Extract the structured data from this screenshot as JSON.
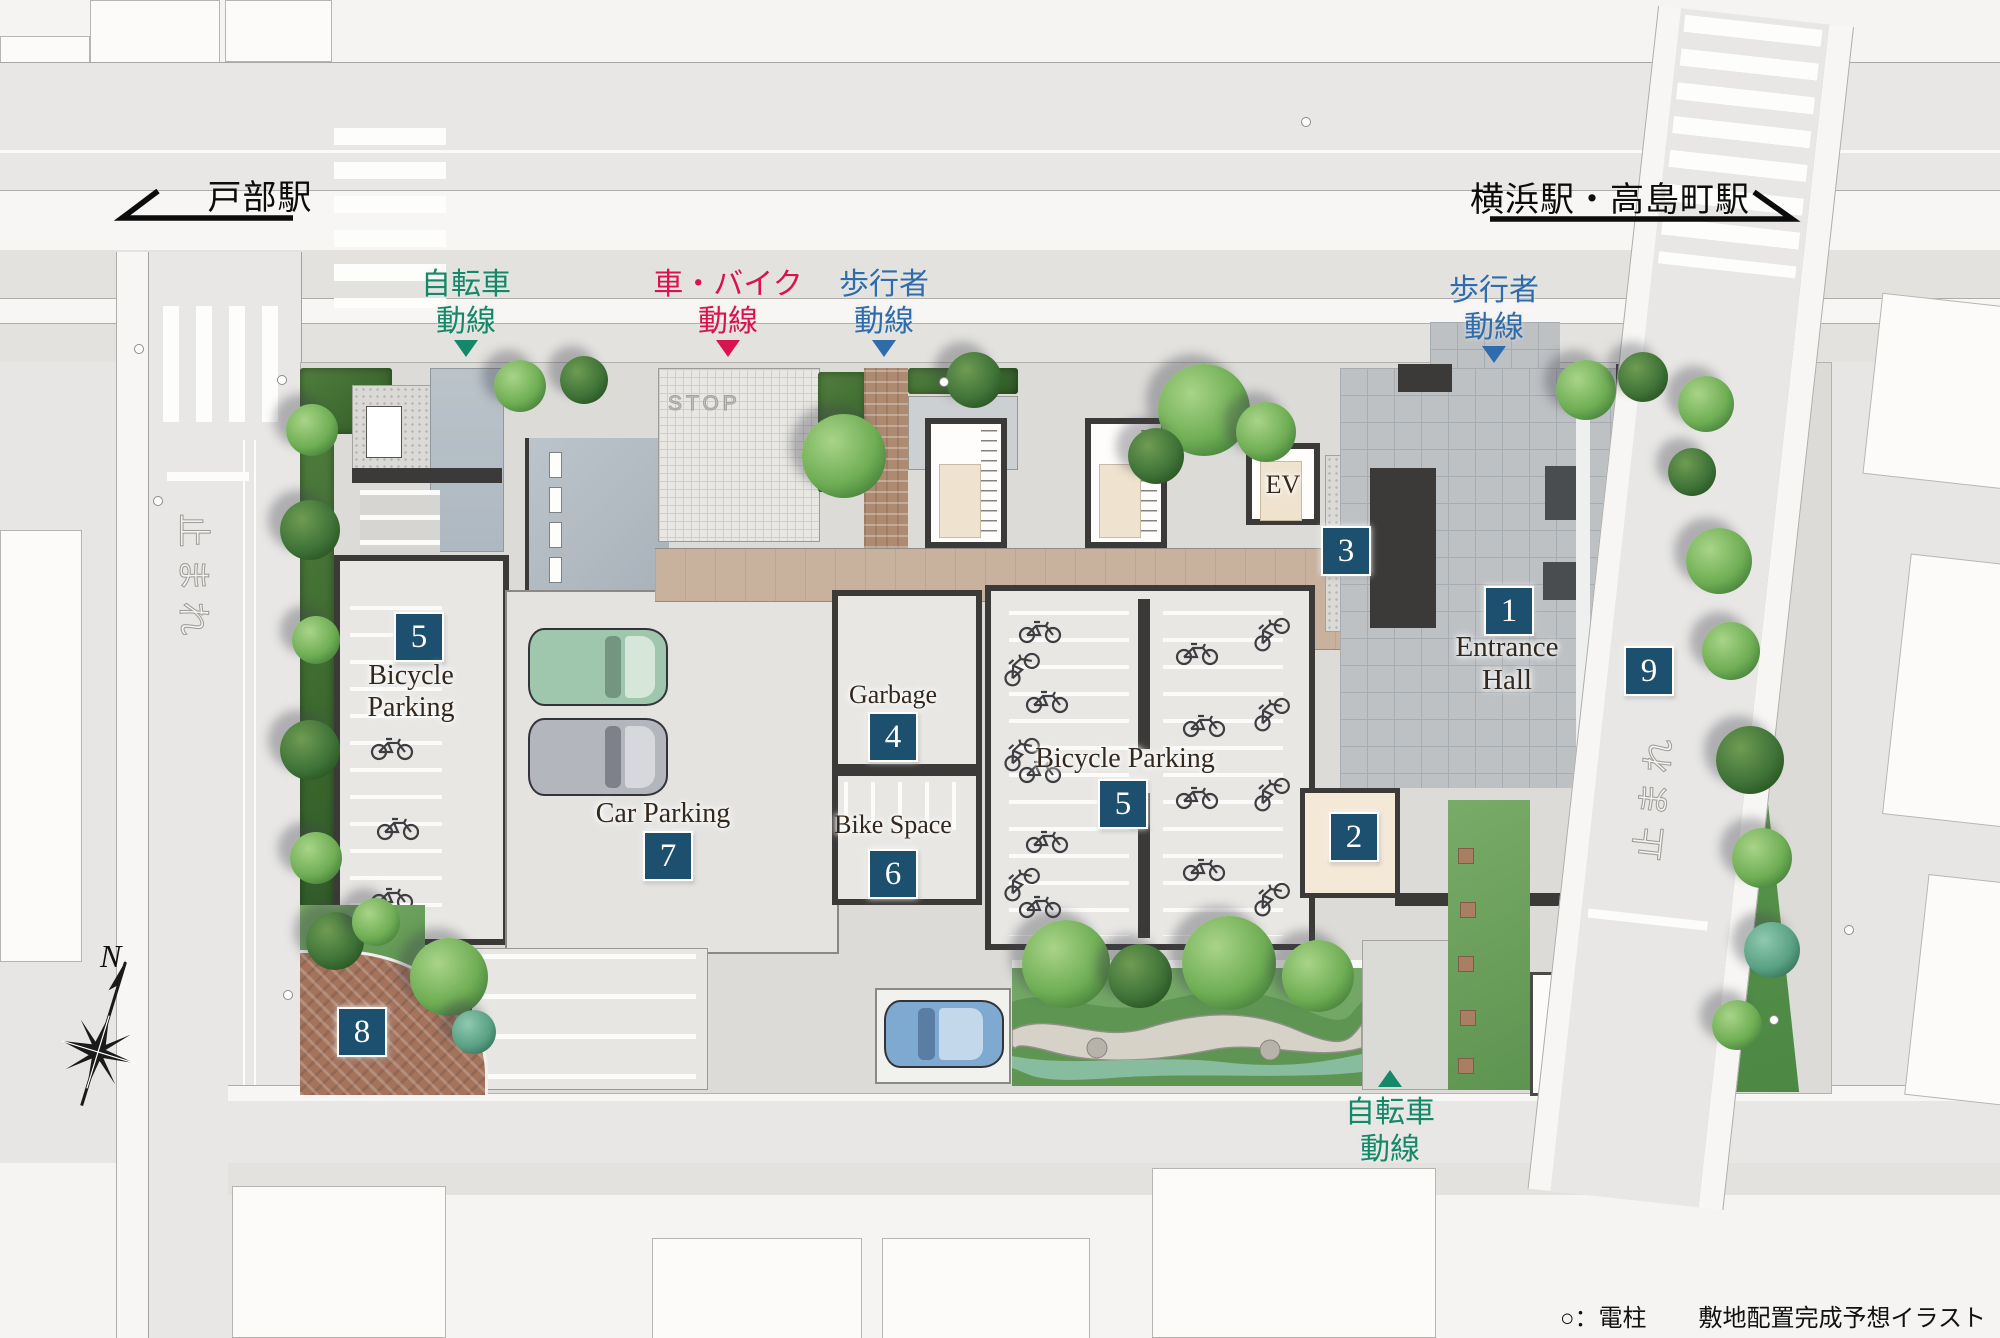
{
  "title": "敷地配置完成予想イラスト",
  "stations": {
    "left": {
      "name": "戸部駅",
      "direction": "left"
    },
    "right": {
      "name": "横浜駅・高島町駅",
      "direction": "right"
    }
  },
  "flows": {
    "bicycle_top": {
      "line1": "自転車",
      "line2": "動線",
      "color": "#15886a",
      "arrow": "down"
    },
    "car_bike": {
      "line1": "車・バイク",
      "line2": "動線",
      "color": "#d8134f",
      "arrow": "down"
    },
    "pedestrian_left": {
      "line1": "歩行者",
      "line2": "動線",
      "color": "#2f6cab",
      "arrow": "down"
    },
    "pedestrian_right": {
      "line1": "歩行者",
      "line2": "動線",
      "color": "#2f6cab",
      "arrow": "down"
    },
    "bicycle_bottom": {
      "line1": "自転車",
      "line2": "動線",
      "color": "#15886a",
      "arrow": "up"
    }
  },
  "areas": {
    "entrance_hall": {
      "badge": "1",
      "line1": "Entrance",
      "line2": "Hall"
    },
    "lobby": {
      "badge": "2"
    },
    "approach": {
      "badge": "3"
    },
    "garbage": {
      "badge": "4",
      "label": "Garbage"
    },
    "bicycle_parking_west": {
      "badge": "5",
      "line1": "Bicycle",
      "line2": "Parking"
    },
    "bicycle_parking_main": {
      "badge": "5",
      "label": "Bicycle Parking"
    },
    "bike_space": {
      "badge": "6",
      "label": "Bike Space"
    },
    "car_parking": {
      "badge": "7",
      "label": "Car Parking"
    },
    "corner_plaza": {
      "badge": "8"
    },
    "side_garden": {
      "badge": "9"
    },
    "elevator": {
      "label": "EV"
    }
  },
  "road_markings": {
    "tomare": "止まれ",
    "stop_paint": "STOP"
  },
  "compass": {
    "north_label": "N"
  },
  "legend": {
    "utility_pole": "○：電柱",
    "caption": "敷地配置完成予想イラスト"
  },
  "colors": {
    "badge_blue": "#1d4f6e",
    "flow_green": "#15886a",
    "flow_red": "#d8134f",
    "flow_blue": "#2f6cab",
    "wall_dark": "#3c3a38",
    "wood_deck": "#c8b29e",
    "brick": "#ad8a70",
    "entrance_paving": "#bdc1c4"
  }
}
